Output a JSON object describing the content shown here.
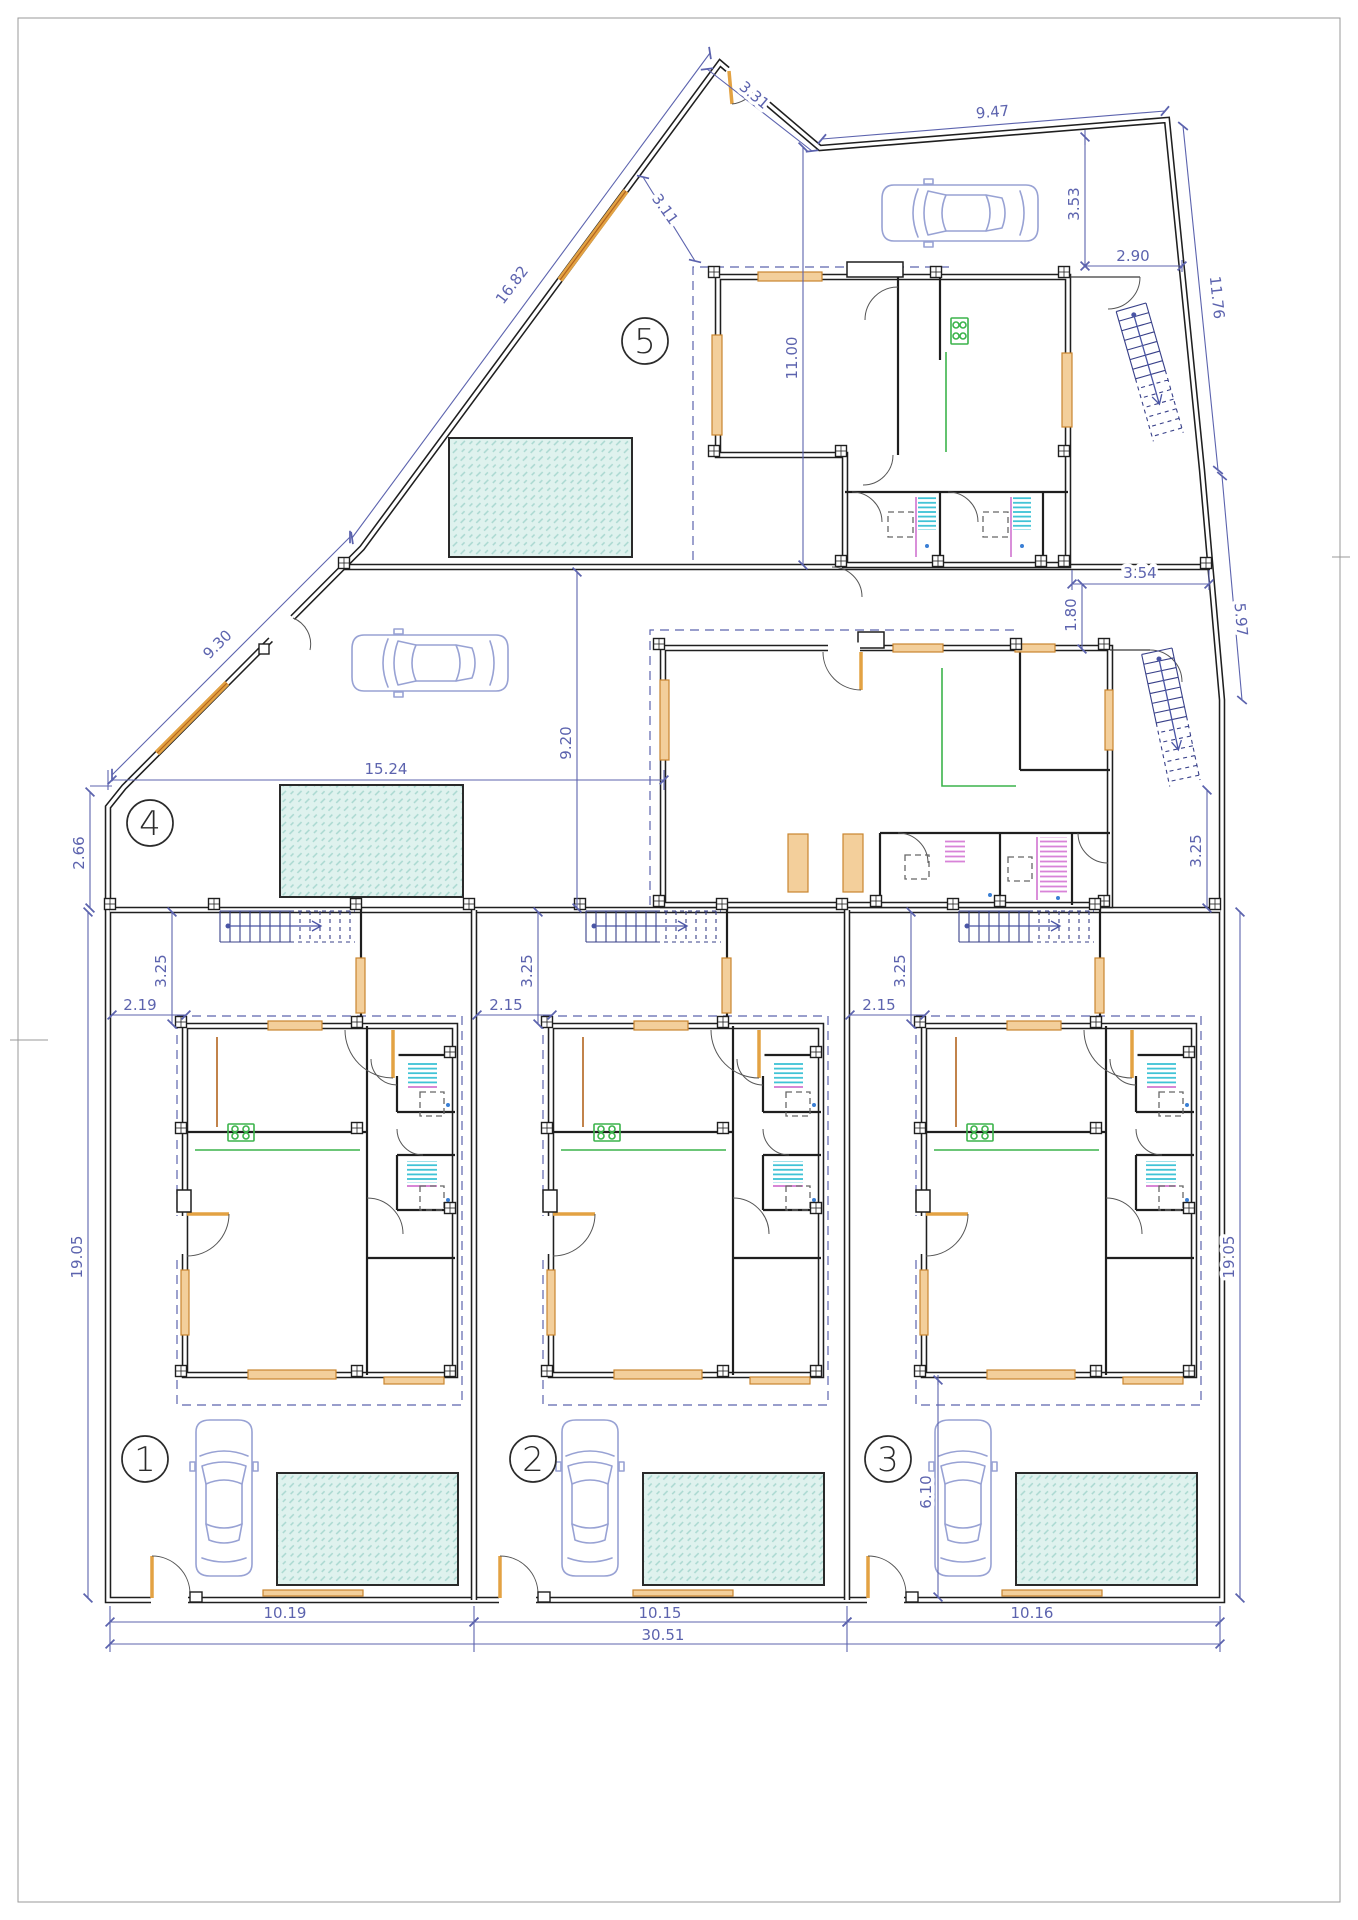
{
  "document": {
    "type": "architectural-site-floor-plan",
    "plots_count": 5,
    "units_note": "ground floor plan, dimensions in meters"
  },
  "plots": [
    {
      "label": "1"
    },
    {
      "label": "2"
    },
    {
      "label": "3"
    },
    {
      "label": "4"
    },
    {
      "label": "5"
    }
  ],
  "dims": [
    {
      "name": "top-notch-diagonal",
      "v": "3.31"
    },
    {
      "name": "top-edge",
      "v": "9.47"
    },
    {
      "name": "top-right-depth",
      "v": "3.53"
    },
    {
      "name": "top-right-width",
      "v": "2.90"
    },
    {
      "name": "right-edge-upper-diagonal",
      "v": "11.76"
    },
    {
      "name": "plot5-porch-diagonal",
      "v": "3.11"
    },
    {
      "name": "left-edge-upper-diagonal",
      "v": "16.82"
    },
    {
      "name": "plot5-depth",
      "v": "11.00"
    },
    {
      "name": "mid-right-width",
      "v": "3.54"
    },
    {
      "name": "mid-right-height",
      "v": "1.80"
    },
    {
      "name": "right-edge-mid-diagonal",
      "v": "5.97"
    },
    {
      "name": "left-edge-lower-diagonal",
      "v": "9.30"
    },
    {
      "name": "plot4-yard-width",
      "v": "15.24"
    },
    {
      "name": "left-edge-step",
      "v": "2.66"
    },
    {
      "name": "plot4-depth",
      "v": "9.20"
    },
    {
      "name": "right-yard-depth",
      "v": "3.25"
    },
    {
      "name": "left-edge-lower",
      "v": "19.05"
    },
    {
      "name": "right-edge-lower",
      "v": "19.05"
    },
    {
      "name": "plot1-front-setback",
      "v": "3.25"
    },
    {
      "name": "plot1-side-setback",
      "v": "2.19"
    },
    {
      "name": "plot2-front-setback",
      "v": "3.25"
    },
    {
      "name": "plot2-side-setback",
      "v": "2.15"
    },
    {
      "name": "plot3-front-setback",
      "v": "3.25"
    },
    {
      "name": "plot3-side-setback",
      "v": "2.15"
    },
    {
      "name": "plot3-rear-yard-depth",
      "v": "6.10"
    },
    {
      "name": "plot1-width",
      "v": "10.19"
    },
    {
      "name": "plot2-width",
      "v": "10.15"
    },
    {
      "name": "plot3-width",
      "v": "10.16"
    },
    {
      "name": "total-frontage",
      "v": "30.51"
    }
  ],
  "colors": {
    "wall": "#1f1f1f",
    "dimension": "#5c63ae",
    "window_frame": "#c9852f",
    "window_fill": "#f3cf9b",
    "door_leaf": "#e3a243",
    "kitchen": "#3cb44b",
    "pool_fill": "#dff2ee",
    "pool_hatch": "#a9d8d0",
    "shower_cyan": "#3fc3d6",
    "shower_magenta": "#d883d8",
    "car_outline": "#98a2d4",
    "stair": "#384089",
    "paper_border": "#9a9a9a"
  },
  "symbols": [
    "car-icon",
    "pool",
    "staircase-icon",
    "stove-icon",
    "shower-tray",
    "column-post",
    "door-swing",
    "plot-number-badge"
  ]
}
